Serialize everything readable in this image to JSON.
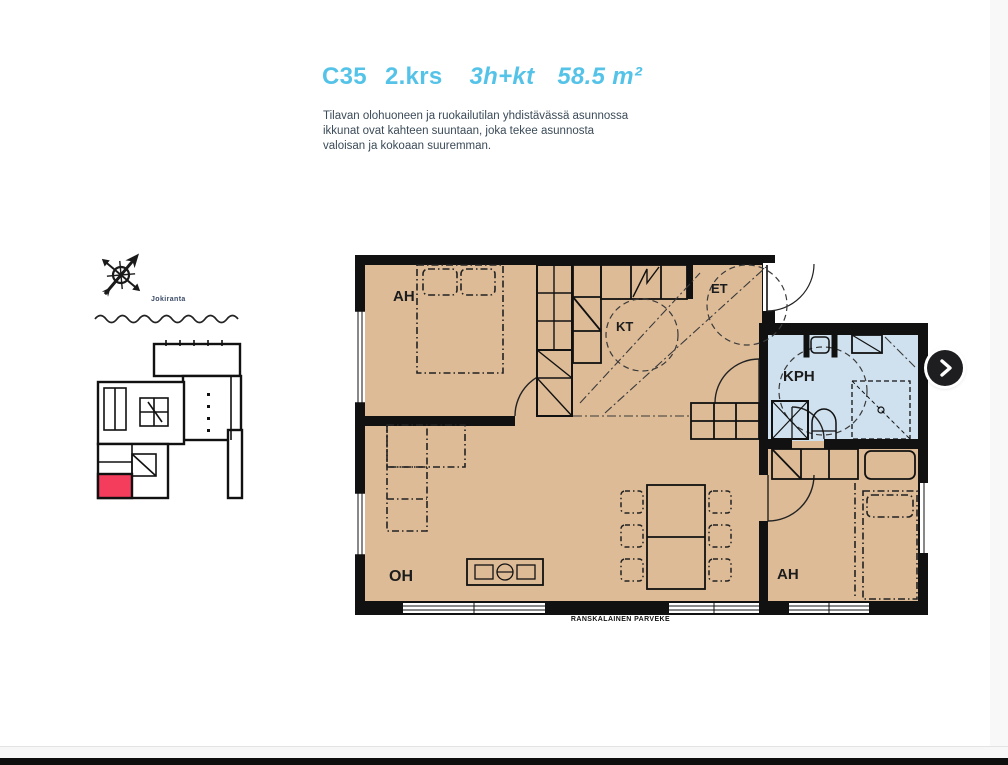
{
  "header": {
    "unit": "C35",
    "floor": "2.krs",
    "layout": "3h+kt",
    "area": "58.5 m²"
  },
  "description": {
    "lines": [
      "Tilavan olohuoneen ja ruokailutilan yhdistävässä asunnossa",
      "ikkunat ovat kahteen suuntaan, joka tekee asunnosta",
      "valoisan ja kokoaan suuremman."
    ]
  },
  "site": {
    "water_label": "Jokiranta"
  },
  "floorplan": {
    "rooms": {
      "bedroom1": "AH",
      "kitchen": "KT",
      "entry": "ET",
      "bathroom": "KPH",
      "living": "OH",
      "bedroom2": "AH"
    },
    "balcony_label": "RANSKALAINEN PARVEKE"
  },
  "colors": {
    "accent_blue": "#55c3e8",
    "body_text": "#3b4b58",
    "floor_tan": "#ddbb97",
    "bathroom_blue": "#cfe1ee",
    "unit_highlight": "#f43c5c",
    "wall_black": "#111111"
  }
}
